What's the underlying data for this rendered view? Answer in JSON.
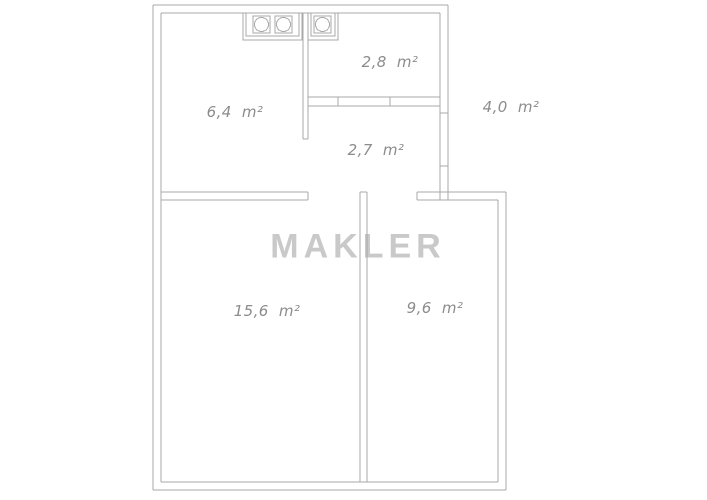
{
  "watermark": {
    "text": "MAKLER"
  },
  "rooms": [
    {
      "id": "kitchen",
      "label": "6,4 m²"
    },
    {
      "id": "bathroom",
      "label": "2,8 m²"
    },
    {
      "id": "hallway",
      "label": "2,7 m²"
    },
    {
      "id": "balcony",
      "label": "4,0 m²"
    },
    {
      "id": "room-large",
      "label": "15,6 m²"
    },
    {
      "id": "room-small",
      "label": "9,6 m²"
    }
  ],
  "icons": {
    "burner": "circle-in-square",
    "left_unit_burner_count": 2,
    "right_unit_burner_count": 1
  },
  "colors": {
    "background": "#ffffff",
    "walls": "#a8a8a8",
    "labels": "#8c8c8c",
    "watermark": "#c9c9c9"
  }
}
